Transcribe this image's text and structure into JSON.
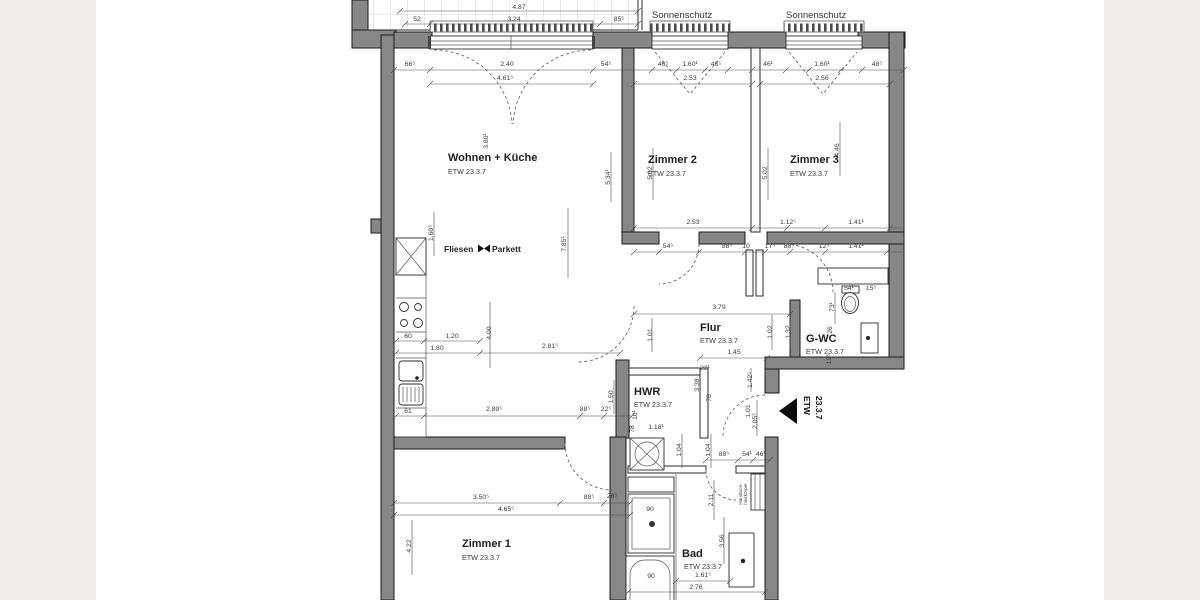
{
  "rooms": {
    "wohnen": {
      "name": "Wohnen + Küche",
      "etw": "ETW 23.3.7"
    },
    "zimmer2": {
      "name": "Zimmer 2",
      "etw": "ETW 23.3.7"
    },
    "zimmer3": {
      "name": "Zimmer 3",
      "etw": "ETW 23.3.7"
    },
    "flur": {
      "name": "Flur",
      "etw": "ETW 23.3.7"
    },
    "gwc": {
      "name": "G-WC",
      "etw": "ETW 23.3.7"
    },
    "hwr": {
      "name": "HWR",
      "etw": "ETW 23.3.7"
    },
    "zimmer1": {
      "name": "Zimmer 1",
      "etw": "ETW 23.3.7"
    },
    "bad": {
      "name": "Bad",
      "etw": "ETW 23.3.7"
    }
  },
  "annotations": {
    "sonnenschutz_left": "Sonnenschutz",
    "sonnenschutz_right": "Sonnenschutz",
    "fliesen": "Fliesen",
    "parkett": "Parkett",
    "entrance_line1": "ETW",
    "entrance_line2": "23.3.7",
    "radiator_line1": "Handtuch-",
    "radiator_line2": "heizkörper"
  },
  "colors": {
    "wall": "#878787",
    "dim": "#3a3a3a",
    "page_band": "#f0eeea",
    "paper": "#ffffff"
  },
  "dimensions": [
    {
      "x": 519,
      "y": 9,
      "t": "4.87"
    },
    {
      "x": 417,
      "y": 21,
      "t": "52"
    },
    {
      "x": 514,
      "y": 21,
      "t": "3.24"
    },
    {
      "x": 619,
      "y": 21,
      "t": "85⁵"
    },
    {
      "x": 410,
      "y": 66,
      "t": "66⁵"
    },
    {
      "x": 507,
      "y": 66,
      "t": "2.40"
    },
    {
      "x": 606,
      "y": 66,
      "t": "54⁵"
    },
    {
      "x": 663,
      "y": 66,
      "t": "46⁵"
    },
    {
      "x": 690,
      "y": 66,
      "t": "1.60¹"
    },
    {
      "x": 716,
      "y": 66,
      "t": "46⁵"
    },
    {
      "x": 768,
      "y": 66,
      "t": "46¹"
    },
    {
      "x": 822,
      "y": 66,
      "t": "1.60¹"
    },
    {
      "x": 877,
      "y": 66,
      "t": "48⁵"
    },
    {
      "x": 505,
      "y": 80,
      "t": "4.61⁵"
    },
    {
      "x": 690,
      "y": 80,
      "t": "2.53"
    },
    {
      "x": 822,
      "y": 80,
      "t": "2.56"
    },
    {
      "x": 488,
      "y": 141,
      "t": "3.80¹",
      "r": 1
    },
    {
      "x": 610,
      "y": 177,
      "t": "5.34¹",
      "r": 1
    },
    {
      "x": 566,
      "y": 244,
      "t": "7.85¹",
      "r": 1
    },
    {
      "x": 652,
      "y": 173,
      "t": "5.02",
      "r": 1
    },
    {
      "x": 767,
      "y": 173,
      "t": "5.02",
      "r": 1
    },
    {
      "x": 839,
      "y": 150,
      "t": "4.46",
      "r": 1
    },
    {
      "x": 433,
      "y": 233,
      "t": "1.60⁵",
      "r": 1
    },
    {
      "x": 693,
      "y": 224,
      "t": "2.53"
    },
    {
      "x": 788,
      "y": 224,
      "t": "1.12⁵"
    },
    {
      "x": 856,
      "y": 224,
      "t": "1.41¹"
    },
    {
      "x": 668,
      "y": 248,
      "t": "54⁵"
    },
    {
      "x": 727,
      "y": 248,
      "t": "88⁵"
    },
    {
      "x": 746,
      "y": 248,
      "t": "10"
    },
    {
      "x": 770,
      "y": 248,
      "t": "17⁵"
    },
    {
      "x": 789,
      "y": 248,
      "t": "88⁵"
    },
    {
      "x": 824,
      "y": 248,
      "t": "12⁵"
    },
    {
      "x": 856,
      "y": 248,
      "t": "1.41¹"
    },
    {
      "x": 408,
      "y": 338,
      "t": "60"
    },
    {
      "x": 452,
      "y": 338,
      "t": "1.20"
    },
    {
      "x": 437,
      "y": 350,
      "t": "1.80"
    },
    {
      "x": 550,
      "y": 348,
      "t": "2.81⁵"
    },
    {
      "x": 491,
      "y": 333,
      "t": "4.00",
      "r": 1
    },
    {
      "x": 408,
      "y": 413,
      "t": "61"
    },
    {
      "x": 494,
      "y": 411,
      "t": "2.89⁵"
    },
    {
      "x": 585,
      "y": 411,
      "t": "88⁵"
    },
    {
      "x": 606,
      "y": 411,
      "t": "22⁵"
    },
    {
      "x": 613,
      "y": 397,
      "t": "1.50",
      "r": 1
    },
    {
      "x": 719,
      "y": 309,
      "t": "3.79"
    },
    {
      "x": 734,
      "y": 354,
      "t": "1.45"
    },
    {
      "x": 772,
      "y": 332,
      "t": "1.02",
      "r": 1
    },
    {
      "x": 790,
      "y": 332,
      "t": "1.32",
      "r": 1
    },
    {
      "x": 652,
      "y": 335,
      "t": "1.01",
      "r": 1
    },
    {
      "x": 849,
      "y": 290,
      "t": "54¹"
    },
    {
      "x": 871,
      "y": 290,
      "t": "15⁵"
    },
    {
      "x": 834,
      "y": 307,
      "t": "73¹",
      "r": 1
    },
    {
      "x": 832,
      "y": 330,
      "t": "26",
      "r": 1
    },
    {
      "x": 831,
      "y": 359,
      "t": "19⁵",
      "r": 1
    },
    {
      "x": 656,
      "y": 429,
      "t": "1.18¹"
    },
    {
      "x": 681,
      "y": 450,
      "t": "1.04",
      "r": 1
    },
    {
      "x": 710,
      "y": 450,
      "t": "1.04",
      "r": 1
    },
    {
      "x": 699,
      "y": 385,
      "t": "3.38",
      "r": 1
    },
    {
      "x": 711,
      "y": 398,
      "t": "76",
      "r": 1
    },
    {
      "x": 750,
      "y": 411,
      "t": "1.01",
      "r": 1
    },
    {
      "x": 757,
      "y": 421,
      "t": "2.05⁵",
      "r": 1
    },
    {
      "x": 752,
      "y": 380,
      "t": "1.42⁵",
      "r": 1
    },
    {
      "x": 634,
      "y": 429,
      "t": "78",
      "r": 1
    },
    {
      "x": 637,
      "y": 415,
      "t": "10¹",
      "r": 1
    },
    {
      "x": 705,
      "y": 370,
      "t": "22¹"
    },
    {
      "x": 724,
      "y": 456,
      "t": "88⁵"
    },
    {
      "x": 747,
      "y": 456,
      "t": "54¹"
    },
    {
      "x": 761,
      "y": 456,
      "t": "46⁵"
    },
    {
      "x": 481,
      "y": 499,
      "t": "3.50⁵"
    },
    {
      "x": 589,
      "y": 499,
      "t": "88⁵"
    },
    {
      "x": 612,
      "y": 498,
      "t": "26⁵"
    },
    {
      "x": 506,
      "y": 511,
      "t": "4.65⁵"
    },
    {
      "x": 411,
      "y": 546,
      "t": "4.22",
      "r": 1
    },
    {
      "x": 650,
      "y": 511,
      "t": "90"
    },
    {
      "x": 651,
      "y": 578,
      "t": "90"
    },
    {
      "x": 713,
      "y": 500,
      "t": "2.11",
      "r": 1
    },
    {
      "x": 724,
      "y": 541,
      "t": "3.56",
      "r": 1
    },
    {
      "x": 703,
      "y": 577,
      "t": "1.61⁵"
    },
    {
      "x": 696,
      "y": 589,
      "t": "2.76"
    }
  ]
}
